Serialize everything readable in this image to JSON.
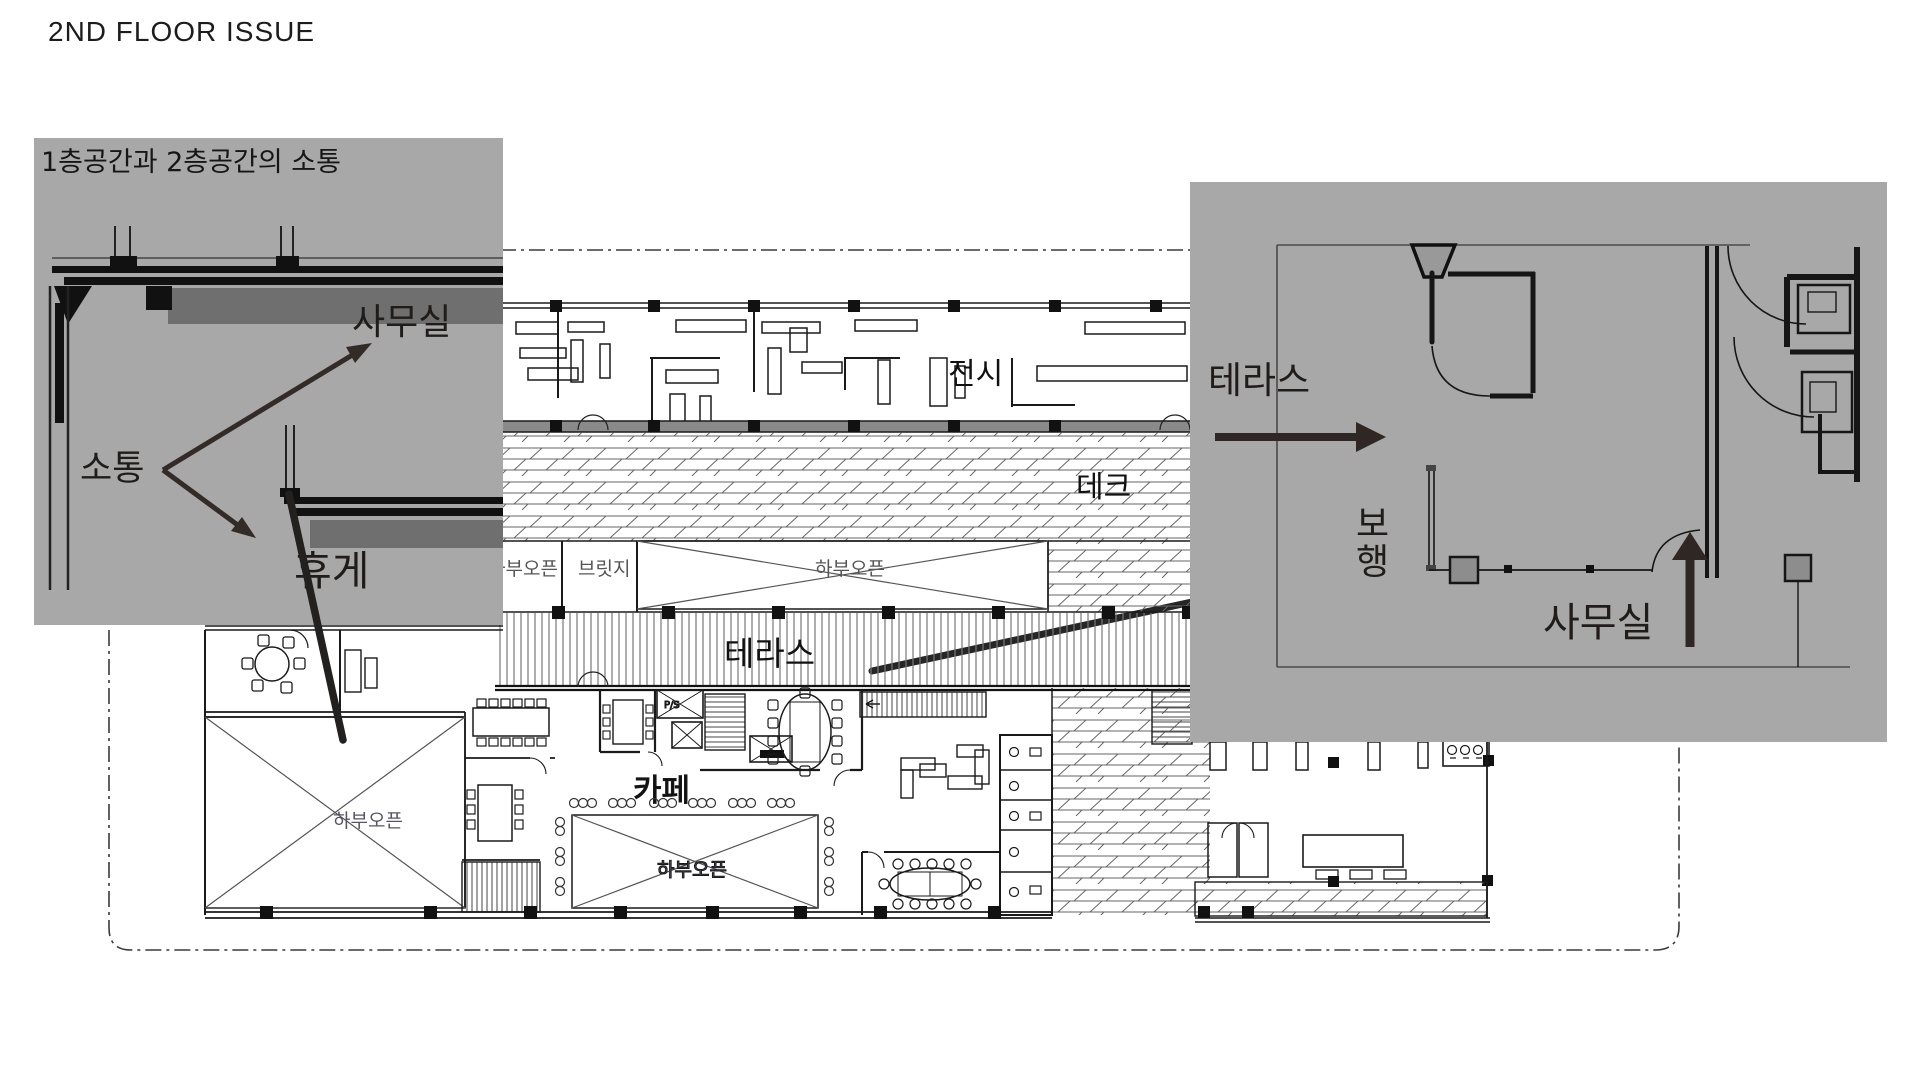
{
  "page": {
    "title": "2ND FLOOR ISSUE"
  },
  "left_inset": {
    "title": "1층공간과 2층공간의 소통",
    "labels": {
      "office": "사무실",
      "communication": "소통",
      "rest": "휴게"
    }
  },
  "right_inset": {
    "labels": {
      "terrace": "테라스",
      "walk_char1": "보",
      "walk_char2": "행",
      "office": "사무실"
    }
  },
  "plan": {
    "labels": {
      "exhibition": "전시",
      "deck": "데크",
      "bridge": "브릿지",
      "terrace": "테라스",
      "cafe": "카페",
      "open_below": "하부오픈",
      "shaft": "P/S"
    }
  },
  "colors": {
    "inset_background": "#a8a8a8",
    "slab_soffit_dark": "#6f6f6f",
    "annotation_arrow": "#332b28",
    "line_black": "#1a1a1a",
    "wall_gray": "#8a8a8a"
  }
}
